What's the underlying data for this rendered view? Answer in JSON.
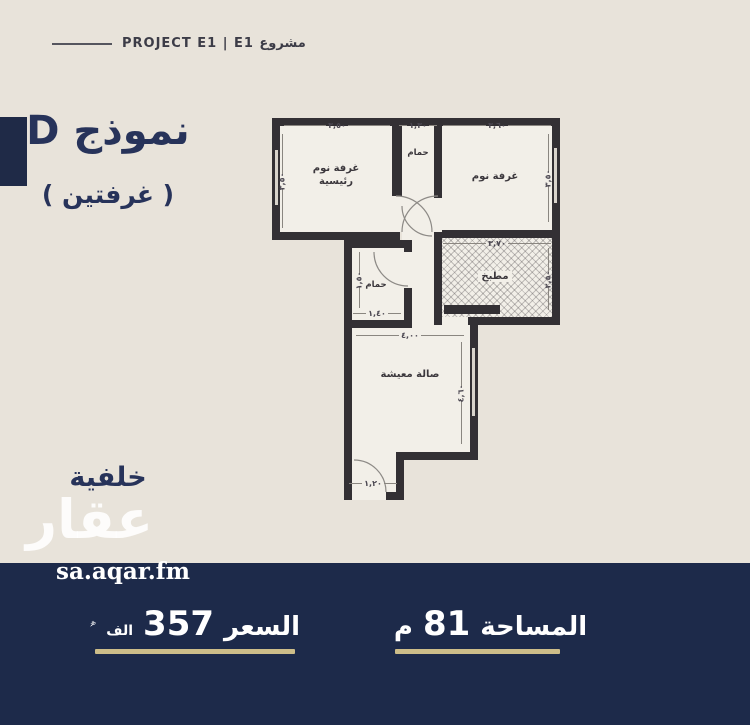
{
  "colors": {
    "background": "#e8e3da",
    "navy_bar": "#1d2a4a",
    "navy_accent_square": "#1f2a47",
    "title_navy": "#27335a",
    "gold_underline": "#cdbd89",
    "plan_wall": "#333034",
    "plan_floor": "#f2efe8"
  },
  "header": {
    "brand_text": "PROJECT E1 | E1 مشروع"
  },
  "side_panel": {
    "model_title": "نموذج D",
    "model_subtitle": "( غرفتين )",
    "view_label": "خلفية"
  },
  "watermark": {
    "logo_arabic": "عقار",
    "site": "sa.aqar.fm"
  },
  "plan": {
    "rooms": {
      "master_bedroom": {
        "label": "غرفة نوم رئيسية"
      },
      "bathroom_top": {
        "label": "حمام"
      },
      "bedroom": {
        "label": "غرفة نوم"
      },
      "kitchen": {
        "label": "مطبخ"
      },
      "bathroom_mid": {
        "label": "حمام"
      },
      "living": {
        "label": "صالة معيشة"
      }
    },
    "dims": {
      "master_top": "٣,٥٠",
      "master_side": "٣,٥٠",
      "bath_top": "١,٣٠",
      "bedroom_top": "٣,٦٠",
      "bedroom_side": "٣,٥٠",
      "kitchen_top": "٣,٧٠",
      "kitchen_side": "٢,٥٠",
      "bath2_side": "١,٥٠",
      "bath2_bottom": "١,٤٠",
      "living_top": "٤,٠٠",
      "living_side": "٤,٦٠",
      "entry_bottom": "١,٢٠"
    }
  },
  "footer": {
    "area": {
      "label": "المساحة",
      "value": "81",
      "unit": "م"
    },
    "price": {
      "label": "السعر",
      "value": "357",
      "unit": "الف",
      "currency_icon": "saudi-riyal-symbol"
    }
  }
}
